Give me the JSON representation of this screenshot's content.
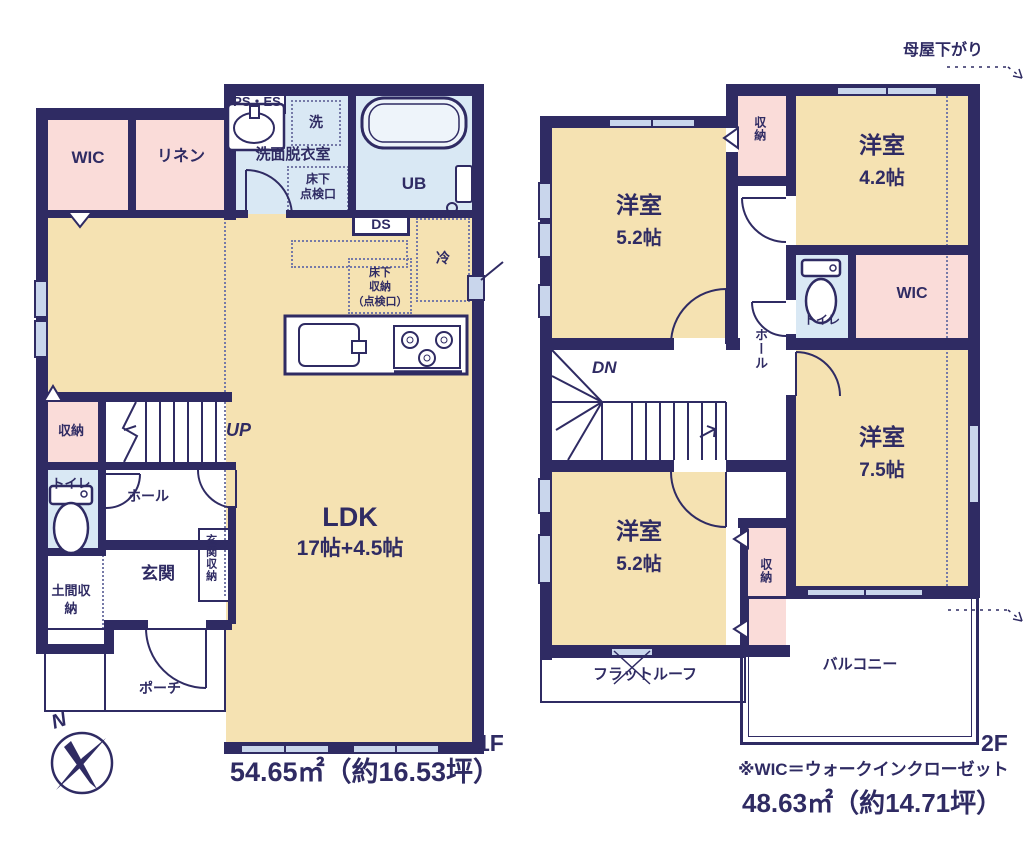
{
  "palette": {
    "wall": "#2f2b63",
    "room_tan": "#f5e2b2",
    "room_pink": "#fadcd9",
    "room_blue": "#d9e8f4",
    "window_fill": "#c9d6ec",
    "text": "#2f2b63"
  },
  "compass": {
    "north": "N"
  },
  "floor1": {
    "label": "1F",
    "area": "54.65㎡（約16.53坪）",
    "rooms": {
      "wic": "WIC",
      "linen": "リネン",
      "ps_es": "PS・ES",
      "washroom": "洗面脱衣室",
      "washer": "洗",
      "hatch_l1": "床下",
      "hatch_l2": "点検口",
      "bath": "UB",
      "ds": "DS",
      "fridge": "冷",
      "ufs_l1": "床下",
      "ufs_l2": "収納",
      "ufs_l3": "（点検口）",
      "ldk": "LDK",
      "ldk_size": "17帖+4.5帖",
      "storage": "収納",
      "toilet": "トイレ",
      "hall": "ホール",
      "entrance": "玄関",
      "entrance_storage": "玄関収納",
      "doma_storage": "土間収納",
      "porch": "ポーチ",
      "up": "UP"
    }
  },
  "floor2": {
    "label": "2F",
    "area": "48.63㎡（約14.71坪）",
    "note": "※WIC＝ウォークインクローゼット",
    "moyasagari": "母屋下がり",
    "rooms": {
      "bedroom_nw": "洋室",
      "bedroom_nw_size": "5.2帖",
      "bedroom_ne": "洋室",
      "bedroom_ne_size": "4.2帖",
      "bedroom_e": "洋室",
      "bedroom_e_size": "7.5帖",
      "bedroom_sw": "洋室",
      "bedroom_sw_size": "5.2帖",
      "closet_n": "収納",
      "closet_s": "収納",
      "wic": "WIC",
      "toilet": "トイレ",
      "hall": "ホール",
      "down": "DN",
      "flat_roof": "フラットルーフ",
      "balcony": "バルコニー"
    }
  }
}
